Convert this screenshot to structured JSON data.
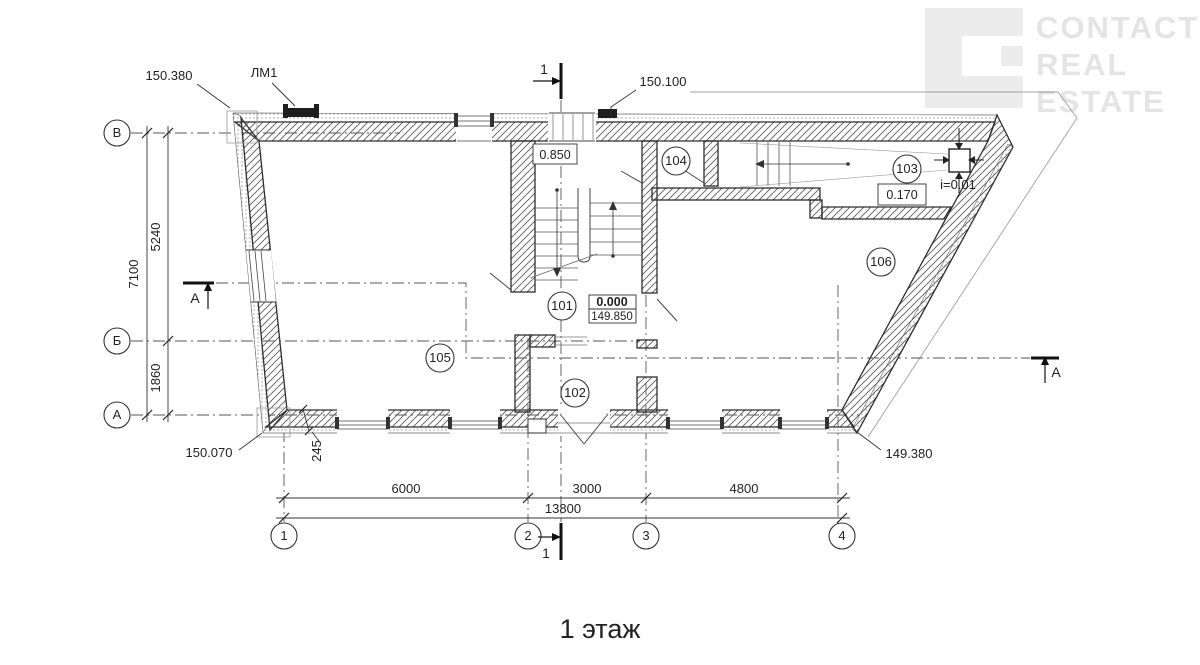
{
  "title": "1 этаж",
  "watermark": {
    "lines": [
      "CONTACT",
      "REAL",
      "ESTATE"
    ]
  },
  "axes": {
    "rows": [
      "В",
      "Б",
      "А"
    ],
    "cols": [
      "1",
      "2",
      "3",
      "4"
    ]
  },
  "rooms": [
    "101",
    "102",
    "103",
    "104",
    "105",
    "106"
  ],
  "dims": {
    "total_v": "7100",
    "v1": "5240",
    "v2": "1860",
    "b1": "6000",
    "b2": "3000",
    "b3": "4800",
    "total_b": "13800",
    "thickness": "245"
  },
  "elev": {
    "tl": "150.380",
    "tc": "150.100",
    "bl": "150.070",
    "br": "149.380",
    "landing": "0.850",
    "zero": "0.000",
    "abs": "149.850",
    "terrace": "0.170",
    "slope": "i=0.01"
  },
  "notes": {
    "lm1": "ЛМ1"
  },
  "sections": {
    "one": "1",
    "a": "А"
  },
  "colors": {
    "ink": "#2e2e2e",
    "hatch": "#5a5a5a",
    "watermark": "#e4e4e4"
  }
}
